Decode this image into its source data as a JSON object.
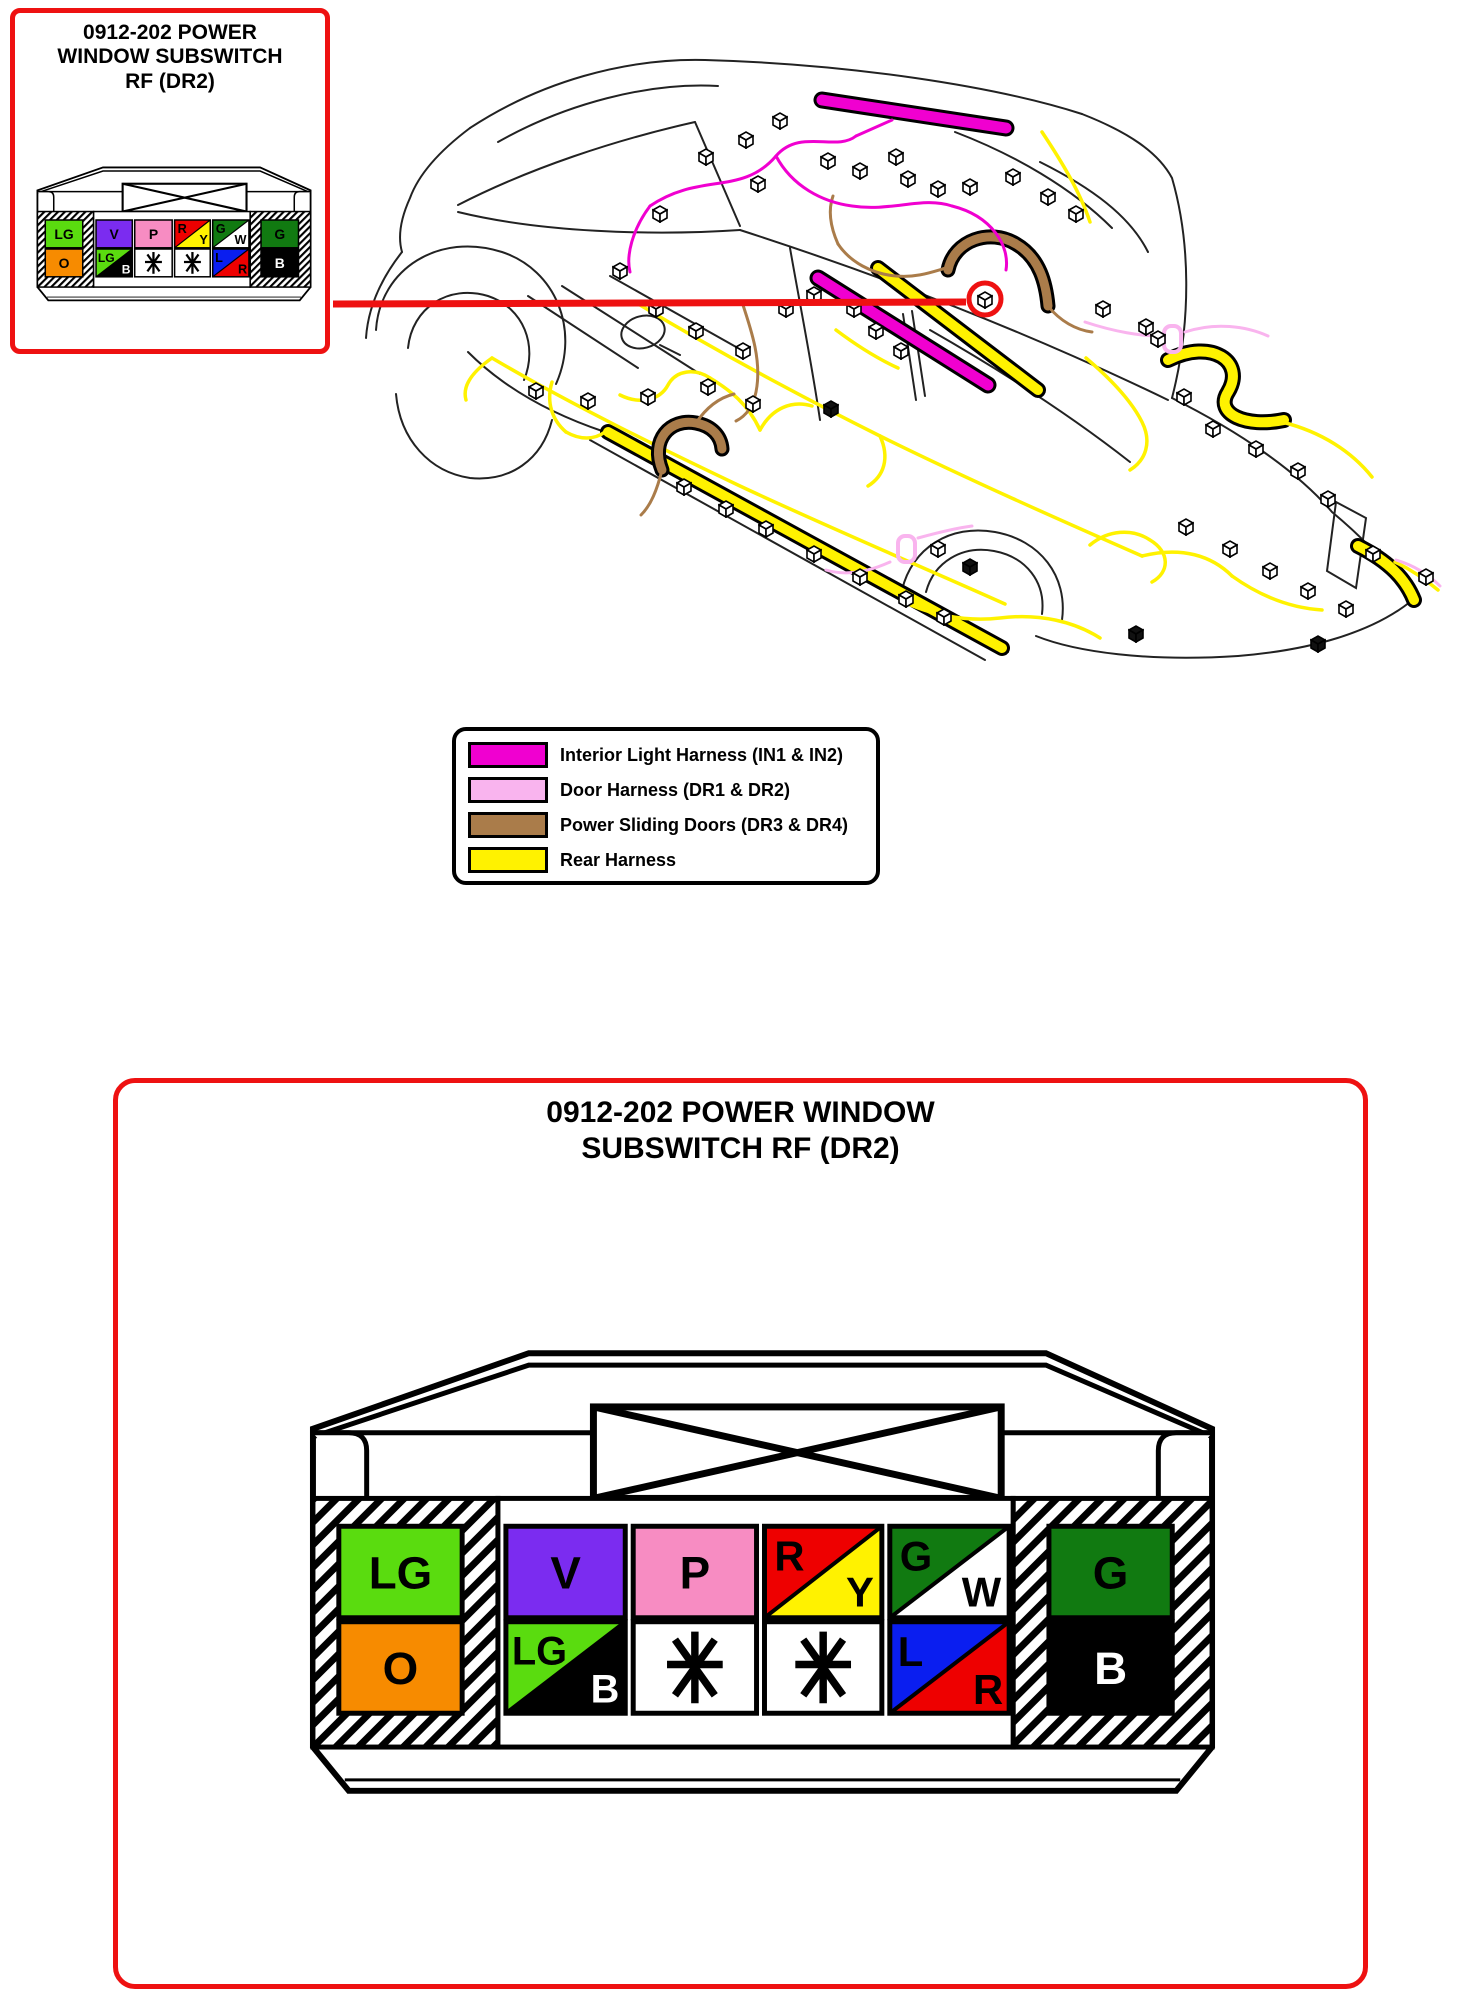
{
  "callout": {
    "title_lines": [
      "0912-202 POWER",
      "WINDOW SUBSWITCH",
      "RF (DR2)"
    ]
  },
  "panel": {
    "title_lines": [
      "0912-202 POWER WINDOW",
      "SUBSWITCH RF (DR2)"
    ]
  },
  "legend": {
    "items": [
      {
        "label": "Interior Light Harness (IN1 & IN2)",
        "color": "#F000D0"
      },
      {
        "label": "Door Harness (DR1 & DR2)",
        "color": "#F9B4EE"
      },
      {
        "label": "Power Sliding Doors (DR3 & DR4)",
        "color": "#AA7C4A"
      },
      {
        "label": "Rear Harness",
        "color": "#FFF200"
      }
    ]
  },
  "accents": {
    "red": "#EE1111"
  },
  "connector": {
    "pins": {
      "p1": {
        "label": "LG",
        "color": "#5ADC0F",
        "text": "#000000"
      },
      "p2": {
        "label": "V",
        "color": "#7B2CF0",
        "text": "#000000"
      },
      "p3": {
        "label": "P",
        "color": "#F78CC2",
        "text": "#000000"
      },
      "p4": {
        "top_label": "R",
        "top_color": "#EE0000",
        "top_text": "#000000",
        "bottom_label": "Y",
        "bottom_color": "#FFF200",
        "bottom_text": "#000000"
      },
      "p5": {
        "top_label": "G",
        "top_color": "#117A11",
        "top_text": "#000000",
        "bottom_label": "W",
        "bottom_color": "#FFFFFF",
        "bottom_text": "#000000"
      },
      "p6": {
        "label": "G",
        "color": "#117A11",
        "text": "#000000"
      },
      "p7": {
        "label": "O",
        "color": "#F78B00",
        "text": "#000000"
      },
      "p8": {
        "top_label": "LG",
        "top_color": "#5ADC0F",
        "top_text": "#000000",
        "bottom_label": "B",
        "bottom_color": "#000000",
        "bottom_text": "#FFFFFF"
      },
      "p9": {
        "label": "✳"
      },
      "p10": {
        "label": "✳"
      },
      "p11": {
        "top_label": "L",
        "top_color": "#0A1EF0",
        "top_text": "#000000",
        "bottom_label": "R",
        "bottom_color": "#EE0000",
        "bottom_text": "#000000"
      },
      "p12": {
        "label": "B",
        "color": "#000000",
        "text": "#FFFFFF"
      }
    }
  }
}
